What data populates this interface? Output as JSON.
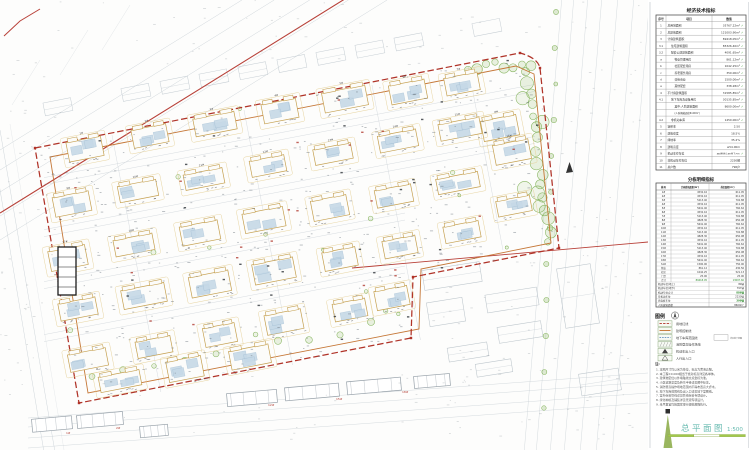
{
  "title_block": {
    "title": "总平面图",
    "scale": "1:500"
  },
  "tables": {
    "economic": {
      "title": "经济技术指标",
      "headers": [
        "序号",
        "项目",
        "数值"
      ],
      "rows": [
        {
          "no": "1",
          "item": "总用地面积",
          "value": "35767.22m²",
          "checked": true,
          "indent": 0
        },
        {
          "no": "2",
          "item": "总建筑面积",
          "value": "121003.90m²",
          "checked": true,
          "indent": 0
        },
        {
          "no": "3",
          "item": "计容建筑面积",
          "value": "89418.05m²",
          "checked": true,
          "indent": 0
        },
        {
          "no": "3.1",
          "item": "住宅建筑面积",
          "value": "85326.40m²",
          "checked": true,
          "indent": 1
        },
        {
          "no": "3.2",
          "item": "配套公建建筑面积",
          "value": "4091.65m²",
          "checked": true,
          "indent": 1
        },
        {
          "no": "a",
          "item": "物业管理用房",
          "value": "861.12m²",
          "checked": true,
          "indent": 2
        },
        {
          "no": "b",
          "item": "社区配套用房",
          "value": "1042.25m²",
          "checked": true,
          "indent": 2
        },
        {
          "no": "c",
          "item": "养老服务用房",
          "value": "350.00m²",
          "checked": true,
          "indent": 2
        },
        {
          "no": "d",
          "item": "沿街商业",
          "value": "1500.00m²",
          "checked": true,
          "indent": 2
        },
        {
          "no": "e",
          "item": "其他配套",
          "value": "338.28m²",
          "checked": true,
          "indent": 2
        },
        {
          "no": "4",
          "item": "不计容建筑面积",
          "value": "31585.85m²",
          "checked": true,
          "indent": 0
        },
        {
          "no": "4.1",
          "item": "地下车库及设备用房",
          "value": "30135.85m²",
          "checked": true,
          "indent": 1
        },
        {
          "no": "",
          "item": "其中:人防建筑面积",
          "value": "8600.00m²",
          "checked": true,
          "indent": 2
        },
        {
          "no": "",
          "item": "(人防掩蔽面积6100m²)",
          "value": "",
          "checked": false,
          "indent": 2
        },
        {
          "no": "4.2",
          "item": "非机动车库",
          "value": "1450.00m²",
          "checked": true,
          "indent": 1
        },
        {
          "no": "5",
          "item": "容积率",
          "value": "2.50",
          "checked": false,
          "indent": 0
        },
        {
          "no": "6",
          "item": "建筑密度",
          "value": "18.5%",
          "checked": false,
          "indent": 0
        },
        {
          "no": "7",
          "item": "绿地率",
          "value": "35.2%",
          "checked": false,
          "indent": 0
        },
        {
          "no": "8",
          "item": "建筑高度",
          "value": "≤54.00m",
          "checked": false,
          "indent": 0
        },
        {
          "no": "9",
          "item": "机动车停车位",
          "value": "886辆(地上89/地下797)",
          "checked": true,
          "indent": 0
        },
        {
          "no": "10",
          "item": "非机动车停车位",
          "value": "2230辆",
          "checked": false,
          "indent": 0
        },
        {
          "no": "11",
          "item": "总户数",
          "value": "796户",
          "checked": false,
          "indent": 0
        }
      ]
    },
    "detail": {
      "title": "分栋明细指标",
      "headers": [
        "栋号",
        "计容建筑面积(m²)",
        "基底面积(m²)"
      ],
      "rows": [
        [
          "1#",
          "4532.16",
          "611.05"
        ],
        [
          "2#",
          "4532.16",
          "611.05"
        ],
        [
          "3#",
          "5213.40",
          "702.88"
        ],
        [
          "4#",
          "4532.16",
          "611.05"
        ],
        [
          "5#",
          "5641.40",
          "760.62"
        ],
        [
          "6#",
          "4532.16",
          "611.05"
        ],
        [
          "7#",
          "5213.40",
          "702.88"
        ],
        [
          "8#",
          "4828.30",
          "650.98"
        ],
        [
          "9#",
          "5641.40",
          "760.62"
        ],
        [
          "10#",
          "4532.16",
          "611.05"
        ],
        [
          "11#",
          "5213.40",
          "702.88"
        ],
        [
          "12#",
          "4828.30",
          "650.98"
        ],
        [
          "13#",
          "4532.16",
          "611.05"
        ],
        [
          "14#",
          "5641.40",
          "760.62"
        ],
        [
          "15#",
          "5213.40",
          "702.88"
        ],
        [
          "16#",
          "4828.30",
          "650.98"
        ],
        [
          "17#",
          "4532.16",
          "611.05"
        ],
        [
          "18#",
          "5641.40",
          "760.62"
        ],
        [
          "S1#",
          "1500.00",
          "750.00"
        ],
        [
          "物业",
          "861.12",
          "430.56"
        ],
        [
          "社区",
          "1042.25",
          "521.13"
        ],
        [
          "门卫",
          "25.00",
          "25.00"
        ],
        [
          "合计",
          "89418.05",
          "13097.60"
        ]
      ],
      "summary": [
        {
          "label": "机动车位(地上)",
          "value": "89辆",
          "green": false
        },
        {
          "label": "机动车位(地下)",
          "value": "797辆",
          "green": false
        },
        {
          "label": "机动车位合计",
          "value": "886辆",
          "green": true
        },
        {
          "label": "非机动车位",
          "value": "2230辆",
          "green": false
        },
        {
          "label": "充电桩车位",
          "value": "399辆",
          "green": true
        },
        {
          "label": "人防建筑面积",
          "value": "8600m²",
          "green": false
        }
      ]
    }
  },
  "legend": {
    "title": "图例",
    "items": [
      {
        "symbol": "red-dash-line",
        "label": "用地红线",
        "extra": ""
      },
      {
        "symbol": "orange-line",
        "label": "建筑控制线",
        "extra": ""
      },
      {
        "symbol": "blue-dash-line",
        "label": "地下车库范围线",
        "extra": "详见地下室图"
      },
      {
        "symbol": "hatch-area",
        "label": "消防登高操作场地",
        "extra": ""
      },
      {
        "symbol": "arrow-solid",
        "label": "机动车出入口",
        "extra": ""
      },
      {
        "symbol": "arrow-open",
        "label": "人行出入口",
        "extra": ""
      }
    ]
  },
  "notes": {
    "heading": "注:",
    "lines": [
      "1. 本图尺寸均以米为单位，标高为黄海高程。",
      "2. 本工程±0.000相当于绝对标高详见各单体。",
      "3. 建筑物定位以外墙轴线交点坐标为准。",
      "4. 小区道路宽度及转弯半径详见图中标注。",
      "5. 消防登高操作场地范围内不得布置高大乔木。",
      "6. 地下车库范围线及出入口详见地下室图纸。",
      "7. 室外综合管线详见管线综合专项设计。",
      "8. 绿化种植及铺装详见景观专项设计。",
      "9. 未尽事宜均按国家现行规范规程执行。"
    ]
  },
  "plan": {
    "existing_building_labels": [
      "12#",
      "15#",
      "18#",
      "1#",
      "2#"
    ]
  },
  "colors": {
    "boundary_red": "#b03328",
    "road_red": "#b84038",
    "control_orange": "#c2702c",
    "building_tan": "#c5a050",
    "building_blue": "#c6d9e7",
    "green": "#84b35c",
    "title_teal": "#64b9ae",
    "scale_green": "#8fae4e",
    "check_green": "#3d9b35",
    "context_gray": "#c4ccd2",
    "dark_gray": "#99a3ab"
  }
}
